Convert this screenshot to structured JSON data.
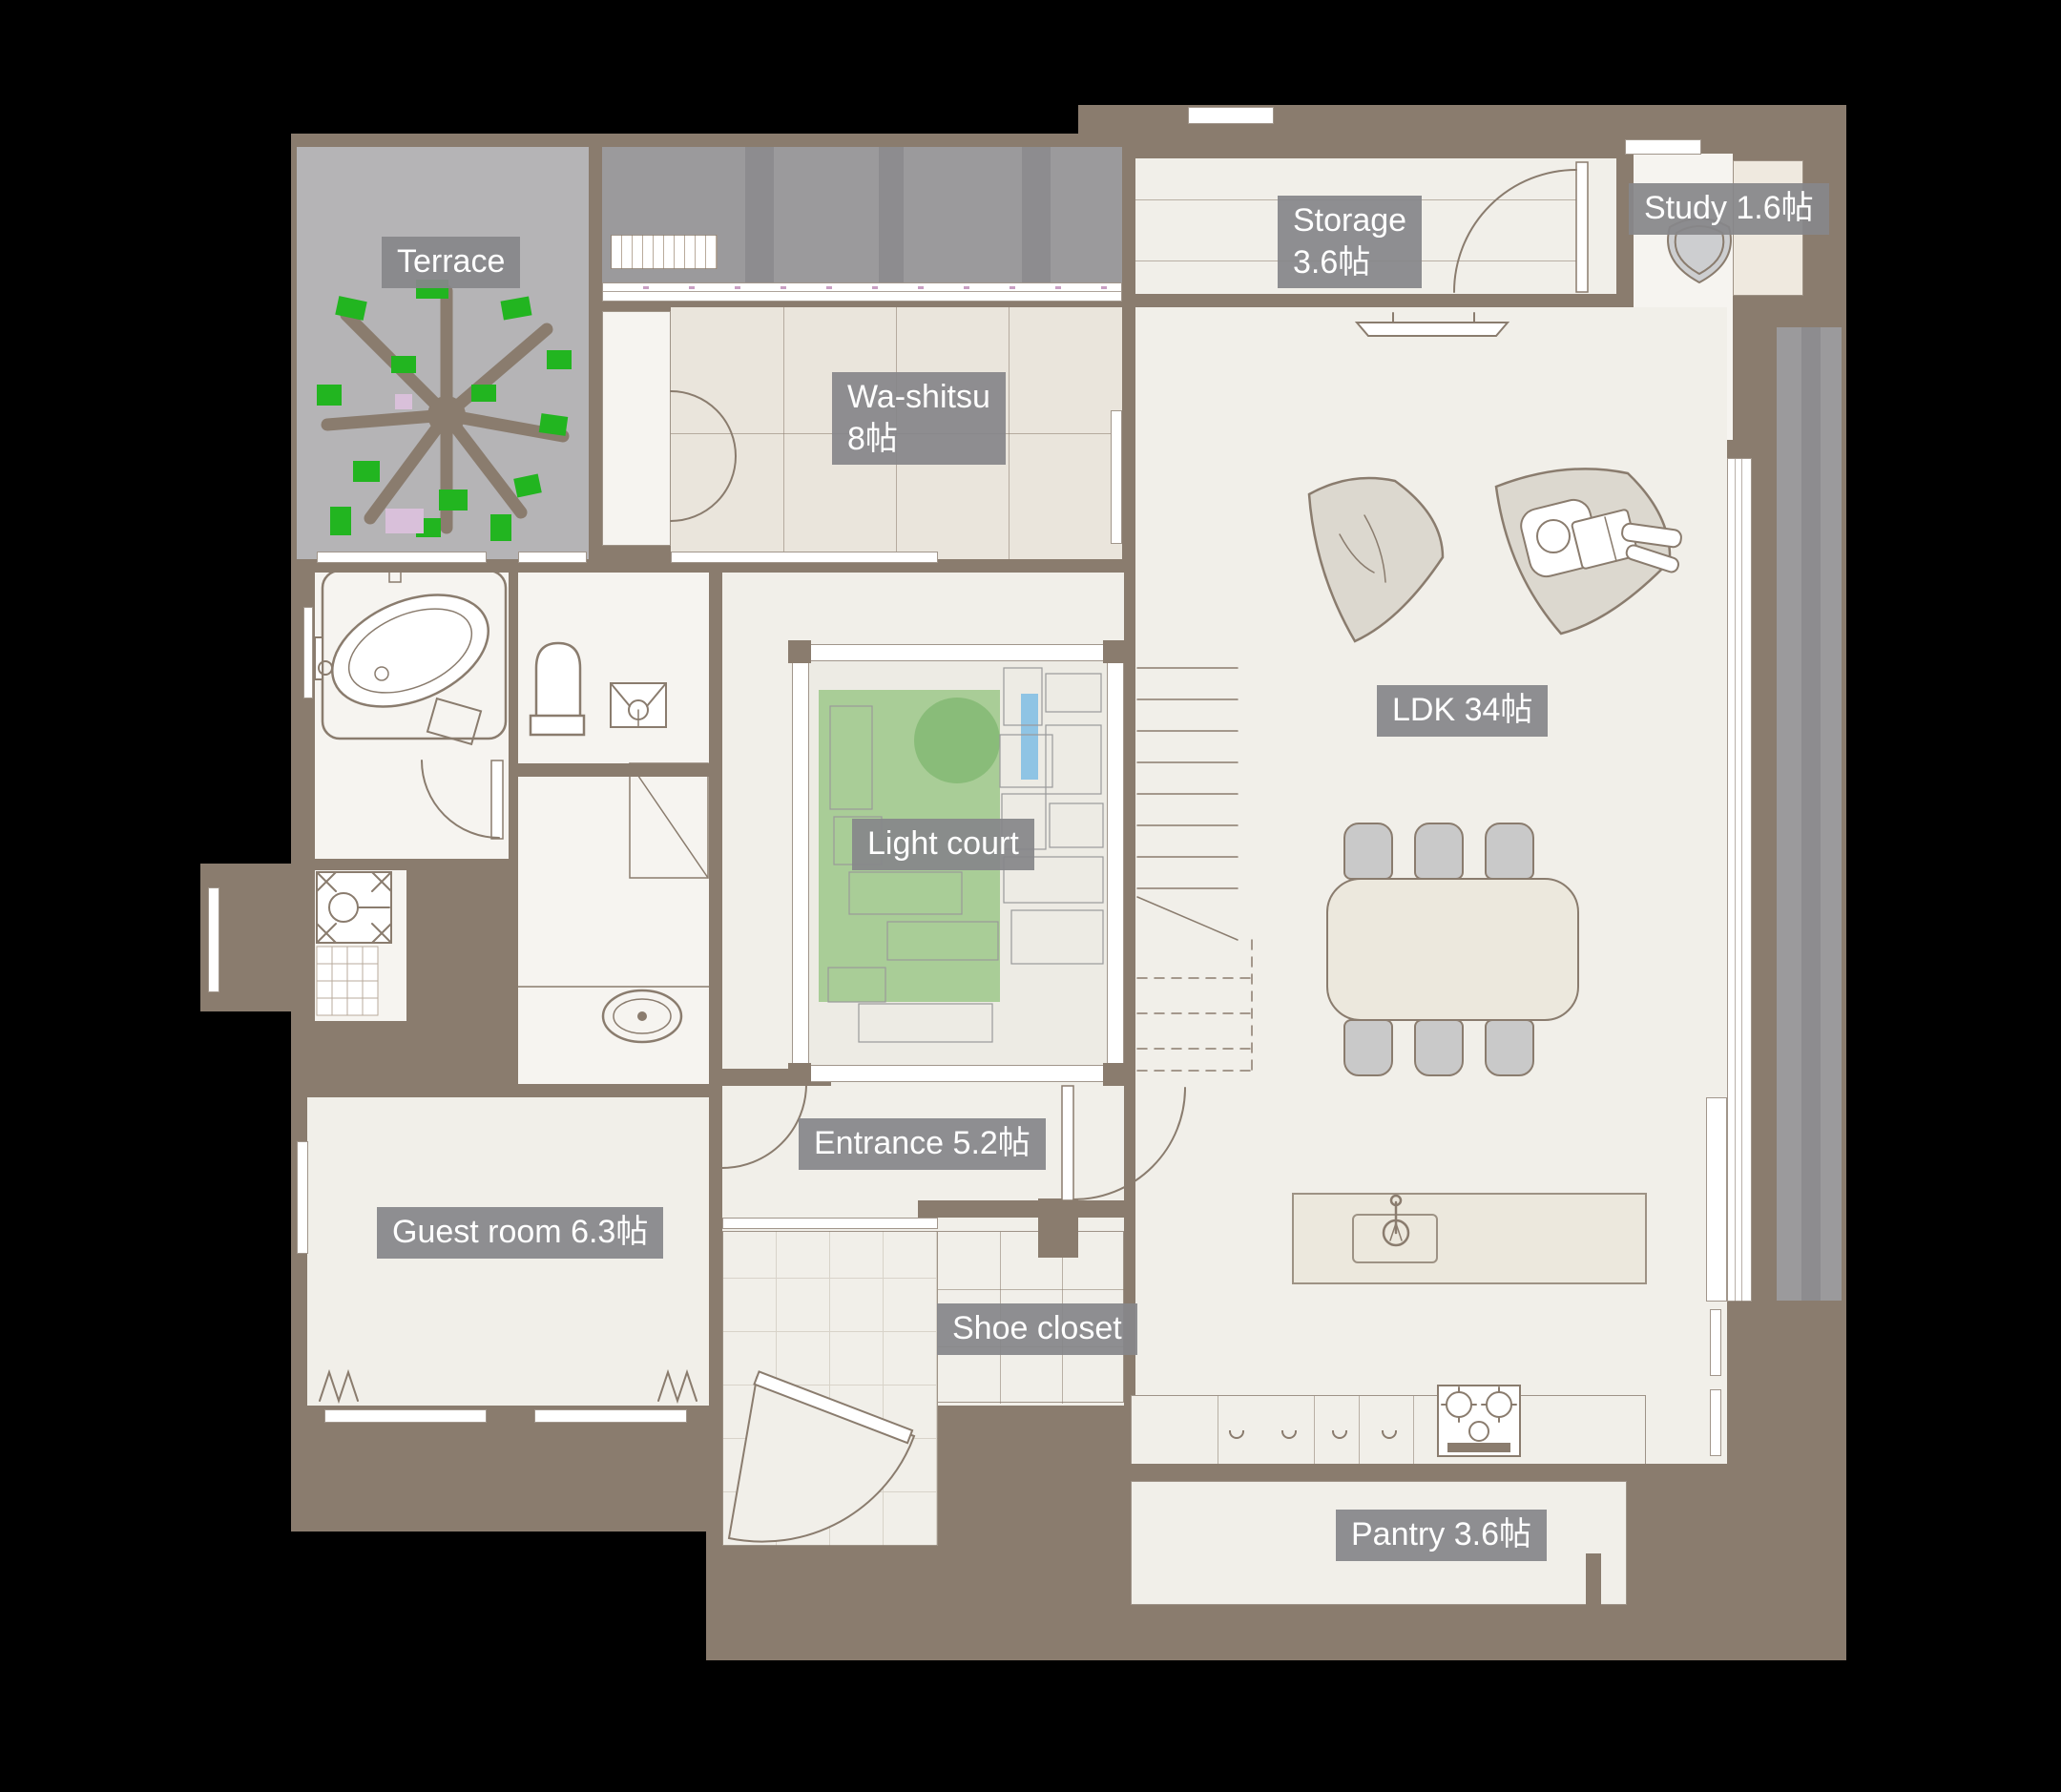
{
  "rooms": {
    "terrace": {
      "label": "Terrace"
    },
    "washitsu": {
      "label": "Wa-shitsu",
      "size": "8帖"
    },
    "storage": {
      "label": "Storage",
      "size": "3.6帖"
    },
    "study": {
      "label": "Study 1.6帖"
    },
    "ldk": {
      "label": "LDK 34帖"
    },
    "light_court": {
      "label": "Light court"
    },
    "entrance": {
      "label": "Entrance 5.2帖"
    },
    "guest_room": {
      "label": "Guest room 6.3帖"
    },
    "shoe_closet": {
      "label": "Shoe closet"
    },
    "pantry": {
      "label": "Pantry 3.6帖"
    }
  },
  "colors": {
    "canvas_bg": "#000000",
    "wall": "#8a7c6e",
    "floor": "#f1efe9",
    "floor_white": "#f6f4f0",
    "tatami": "#eae5dc",
    "terrace": "#b5b4b6",
    "deck": "#9b9a9c",
    "deck_stripe": "#8d8c8f",
    "label_text": "#ffffff",
    "court_green": "#a9cd97",
    "tree_green": "#6fae61",
    "leaf_green": "#22b520",
    "blossom_pink": "#d9c0da",
    "water_blue": "#8fc4e4",
    "furniture": "#ece8dd",
    "chair": "#c9c9c9",
    "tile_line": "#d8d3c9"
  }
}
